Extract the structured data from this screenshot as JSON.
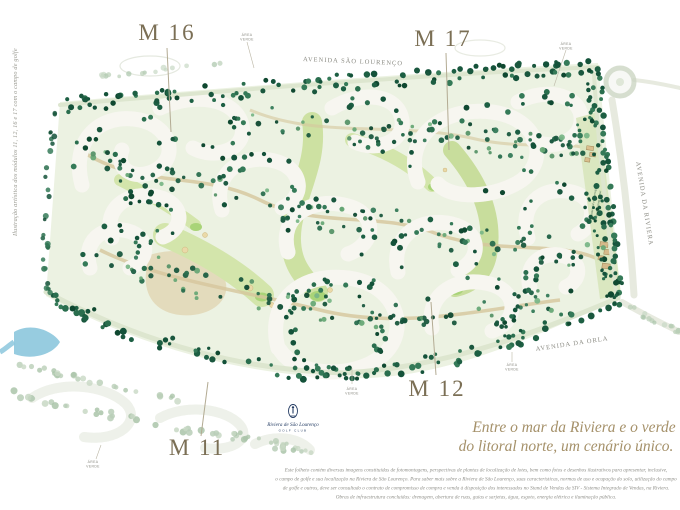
{
  "caption_side": "Ilustração artística dos módulos 11, 12, 16 e 17 com o campo de golfe",
  "modules": {
    "m16": "M 16",
    "m17": "M 17",
    "m12": "M 12",
    "m11": "M 11"
  },
  "streets": {
    "sao_lourenco": "AVENIDA SÃO LOURENÇO",
    "riviera": "AVENIDA DA RIVIERA",
    "orla": "AVENIDA DA ORLA"
  },
  "area_verde": {
    "line1": "ÁREA",
    "line2": "VERDE"
  },
  "commercial": {
    "line1": "Área comercial e de serviços",
    "line2": "futuro Shopping Center"
  },
  "logo": {
    "name": "Riviera de São Lourenço",
    "subtitle": "GOLF CLUB"
  },
  "headline": {
    "line1": "Entre o mar da Riviera e o verde",
    "line2": "do litoral norte, um cenário único."
  },
  "disclaimer": {
    "line1": "Este folheto contém diversas imagens constituídas de fotomontagens, perspectivas de plantas de localização de lotes, bem como fotos e desenhos ilustrativos para apresentar, inclusive,",
    "line2": "o campo de golfe e sua localização na Riviera de São Lourenço. Para saber mais sobre a Riviera de São Lourenço, suas características, normas de uso e ocupação do solo, utilização do campo",
    "line3": "de golfe e outros, deve ser consultado o contrato de compromisso de compra e venda à disposição dos interessados no Stand de Vendas da SIV - Sistema Integrado de Vendas, na Riviera.",
    "line4": "Obras de infraestrutura concluídas: drenagem, abertura de ruas, guias e sarjetas, água, esgoto, energia elétrica e iluminação pública."
  },
  "colors": {
    "headline_text": "#a5916a",
    "module_text": "#7b6f55",
    "street_text": "#8c8c84",
    "tree_dark": "#1d5f43",
    "fairway": "#cde1a2",
    "sand": "#dcc99c",
    "water": "#8cc7dd",
    "logo_navy": "#243c63"
  }
}
